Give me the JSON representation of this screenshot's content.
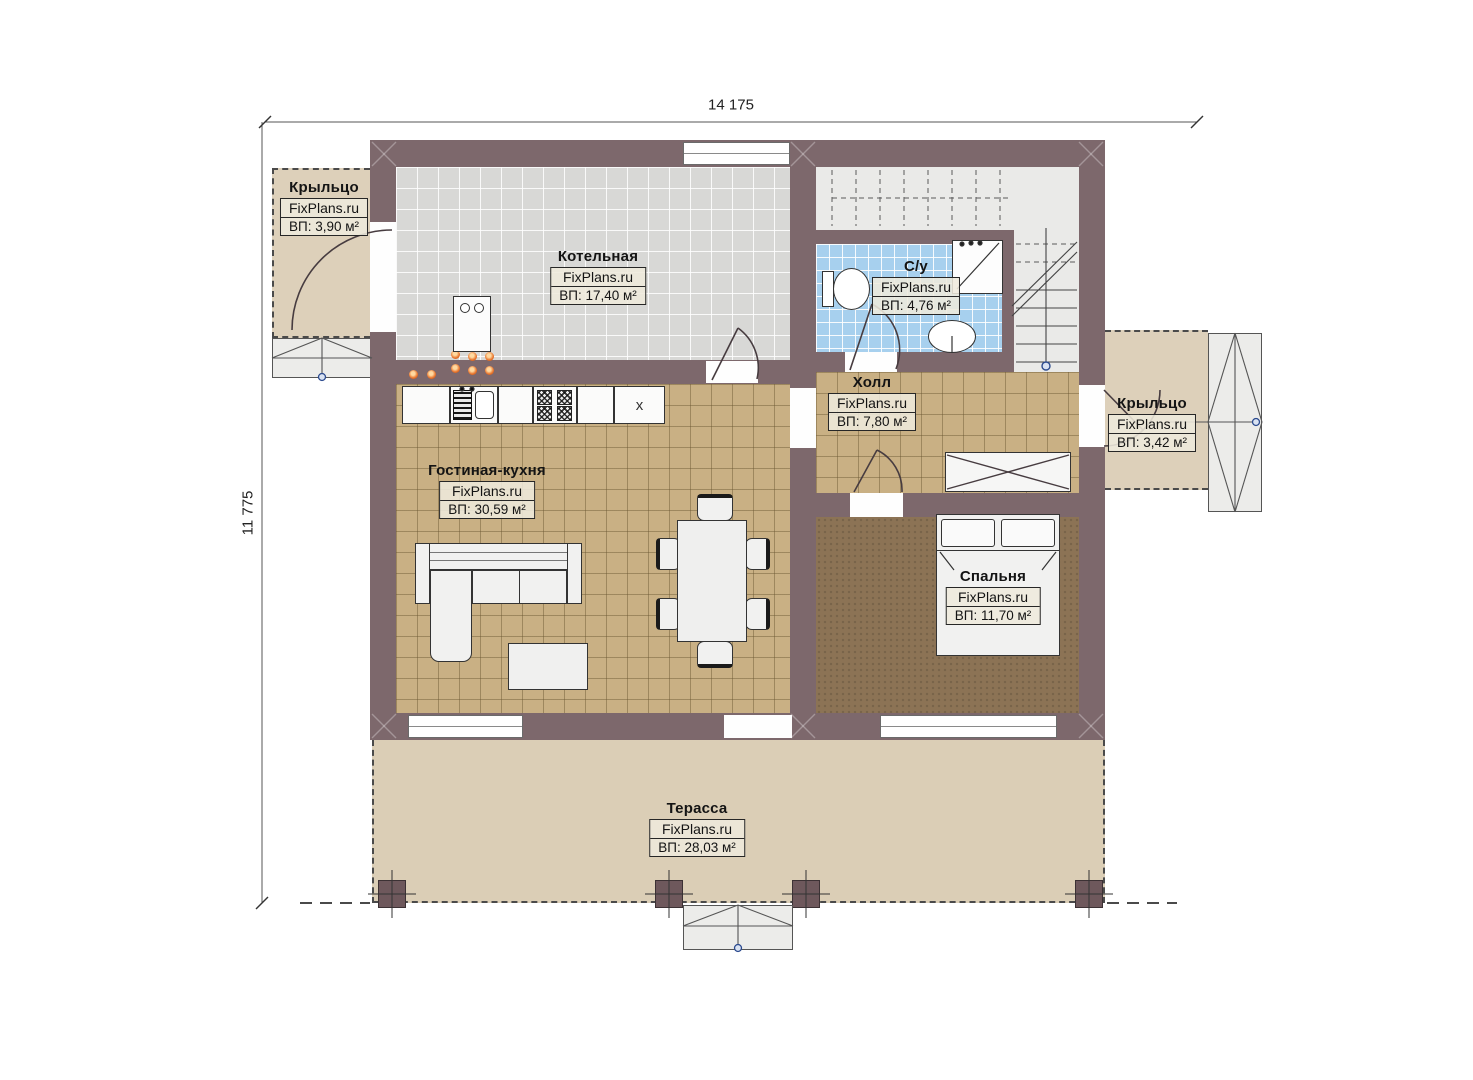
{
  "dimensions": {
    "width_mm": "14 175",
    "height_mm": "11 775"
  },
  "brand": "FixPlans.ru",
  "rooms": [
    {
      "name": "Крыльцо",
      "watermark": "FixPlans.ru",
      "area": "ВП: 3,90 м²"
    },
    {
      "name": "Котельная",
      "watermark": "FixPlans.ru",
      "area": "ВП: 17,40 м²"
    },
    {
      "name": "С/у",
      "watermark": "FixPlans.ru",
      "area": "ВП: 4,76 м²"
    },
    {
      "name": "Холл",
      "watermark": "FixPlans.ru",
      "area": "ВП: 7,80 м²"
    },
    {
      "name": "Крыльцо",
      "watermark": "FixPlans.ru",
      "area": "ВП: 3,42 м²"
    },
    {
      "name": "Гостиная-кухня",
      "watermark": "FixPlans.ru",
      "area": "ВП: 30,59 м²"
    },
    {
      "name": "Спальня",
      "watermark": "FixPlans.ru",
      "area": "ВП: 11,70 м²"
    },
    {
      "name": "Терасса",
      "watermark": "FixPlans.ru",
      "area": "ВП: 28,03 м²"
    }
  ],
  "kitchen": {
    "unit_label": "x"
  },
  "colors": {
    "wall": "#7d686c",
    "floor_tan": "#c9b084",
    "floor_gray": "#d8d8d6",
    "floor_blue": "#a7d0ee",
    "floor_bedroom": "#8c7355",
    "terrace": "#dbceb6",
    "lamp_accent": "#e8742c"
  }
}
